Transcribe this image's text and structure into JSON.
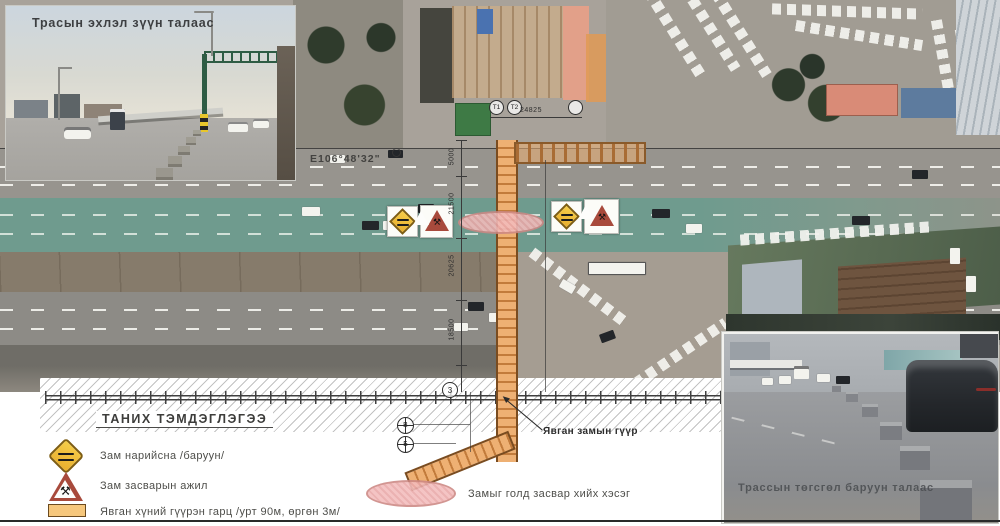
{
  "photos": {
    "start": {
      "caption": "Трасын эхлэл зүүн талаас"
    },
    "end": {
      "caption": "Трассын төгсгөл баруун талаас"
    }
  },
  "map": {
    "coordinate": "E106°48'32\"",
    "bridge_label": "Явган замын гүүр",
    "dimensions": {
      "span": "24825",
      "seg1": "5000",
      "seg2": "21500",
      "seg3": "20625",
      "seg4": "18500"
    },
    "markers": {
      "t1": "Т1",
      "t2": "Т2",
      "rail_point": "3",
      "b1": "В",
      "b2": "Б"
    }
  },
  "legend": {
    "title": "ТАНИХ ТЭМДЭГЛЭГЭЭ",
    "items": [
      {
        "icon": "road-narrows-sign",
        "label": "Зам нарийсна /баруун/"
      },
      {
        "icon": "road-work-sign",
        "label": "Зам засварын ажил"
      },
      {
        "icon": "pedestrian-overpass-bar",
        "label": "Явган хүний гүүрэн гарц /урт 90м, өргөн 3м/"
      },
      {
        "icon": "median-repair-ellipse",
        "label": "Замыг голд засвар хийх хэсэг"
      }
    ]
  },
  "colors": {
    "bridge_orange": "#eeb073",
    "repair_pink": "#f3bcbc",
    "sign_yellow": "#f4c53d",
    "sign_red": "#a84a3c",
    "road_teal": "#6f9b8e"
  }
}
